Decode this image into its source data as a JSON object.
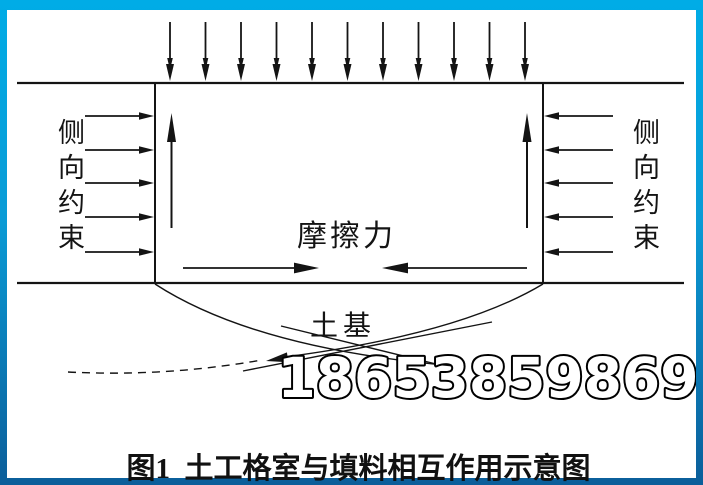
{
  "figure": {
    "left_label": "侧向约束",
    "right_label": "侧向约束",
    "friction_label": "摩擦力",
    "subgrade_label": "土基",
    "caption": "图1  土工格室与填料相互作用示意图",
    "watermark": "18653859869"
  },
  "diagram": {
    "top_pressure_arrow_count": 11,
    "side_constraint_arrow_count_each": 5,
    "side_arrow_y_positions": [
      116,
      150,
      183,
      217,
      252
    ],
    "uplift_arrow_count": 2,
    "friction_arrow_count": 2
  },
  "colors": {
    "frame_top": "#00ace6",
    "frame_bottom": "#0b5e9a",
    "line_color": "#141414",
    "background": "#ffffff",
    "watermark_fill": "#ffffff",
    "watermark_outline": "#000000"
  }
}
